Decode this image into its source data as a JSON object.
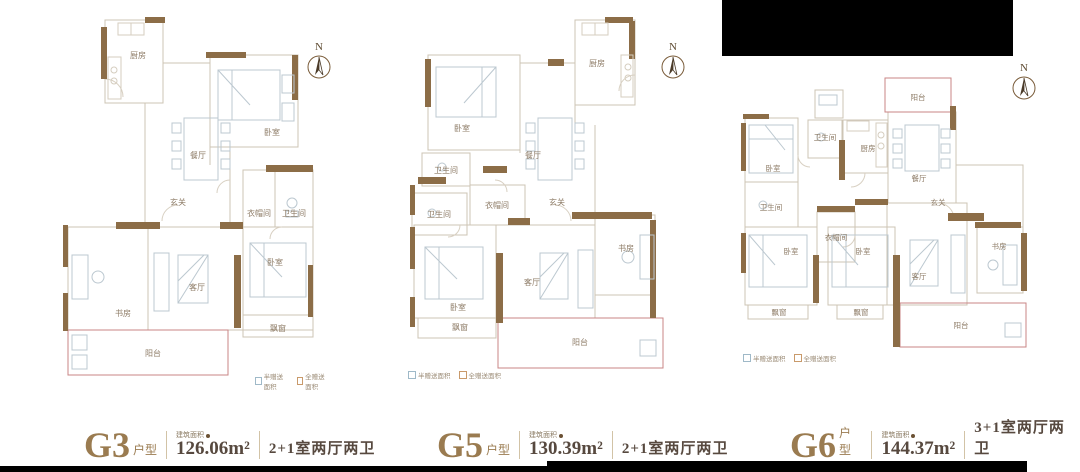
{
  "compass_label": "N",
  "legend": {
    "items": [
      {
        "label": "半赠送面积",
        "color": "#9fb9c8"
      },
      {
        "label": "全赠送面积",
        "color": "#c99a6b"
      }
    ]
  },
  "colors": {
    "accent_gold": "#9a7b50",
    "wall_brown": "#8c6d47",
    "balcony_red": "#c98585",
    "text_dark": "#57493f"
  },
  "plans": [
    {
      "name": "G3",
      "name_suffix": "户型",
      "area_label": "建筑面积",
      "area_value": "126.06m²",
      "layout_text": "2+1室两厅两卫",
      "rooms": {
        "kitchen": "厨房",
        "bedroom_a": "卧室",
        "dining": "餐厅",
        "entry": "玄关",
        "cloakroom": "衣帽间",
        "bathroom_a": "卫生间",
        "study": "书房",
        "living": "客厅",
        "bedroom_b": "卧室",
        "bay_window_a": "飘窗",
        "balcony_a": "阳台"
      }
    },
    {
      "name": "G5",
      "name_suffix": "户型",
      "area_label": "建筑面积",
      "area_value": "130.39m²",
      "layout_text": "2+1室两厅两卫",
      "rooms": {
        "kitchen": "厨房",
        "bedroom_a": "卧室",
        "dining": "餐厅",
        "bathroom_a": "卫生间",
        "cloakroom": "衣帽间",
        "bathroom_b": "卫生间",
        "entry": "玄关",
        "study": "书房",
        "living": "客厅",
        "bedroom_b": "卧室",
        "bay_window_a": "飘窗",
        "balcony_a": "阳台"
      }
    },
    {
      "name": "G6",
      "name_suffix": "户型",
      "area_label": "建筑面积",
      "area_value": "144.37m²",
      "layout_text": "3+1室两厅两卫",
      "rooms": {
        "balcony_a": "阳台",
        "bathroom_a": "卫生间",
        "kitchen": "厨房",
        "bedroom_a": "卧室",
        "dining": "餐厅",
        "bathroom_b": "卫生间",
        "entry": "玄关",
        "cloakroom": "衣帽间",
        "bedroom_b": "卧室",
        "bedroom_c": "卧室",
        "study": "书房",
        "living": "客厅",
        "bay_window_a": "飘窗",
        "bay_window_b": "飘窗",
        "balcony_b": "阳台"
      }
    }
  ]
}
